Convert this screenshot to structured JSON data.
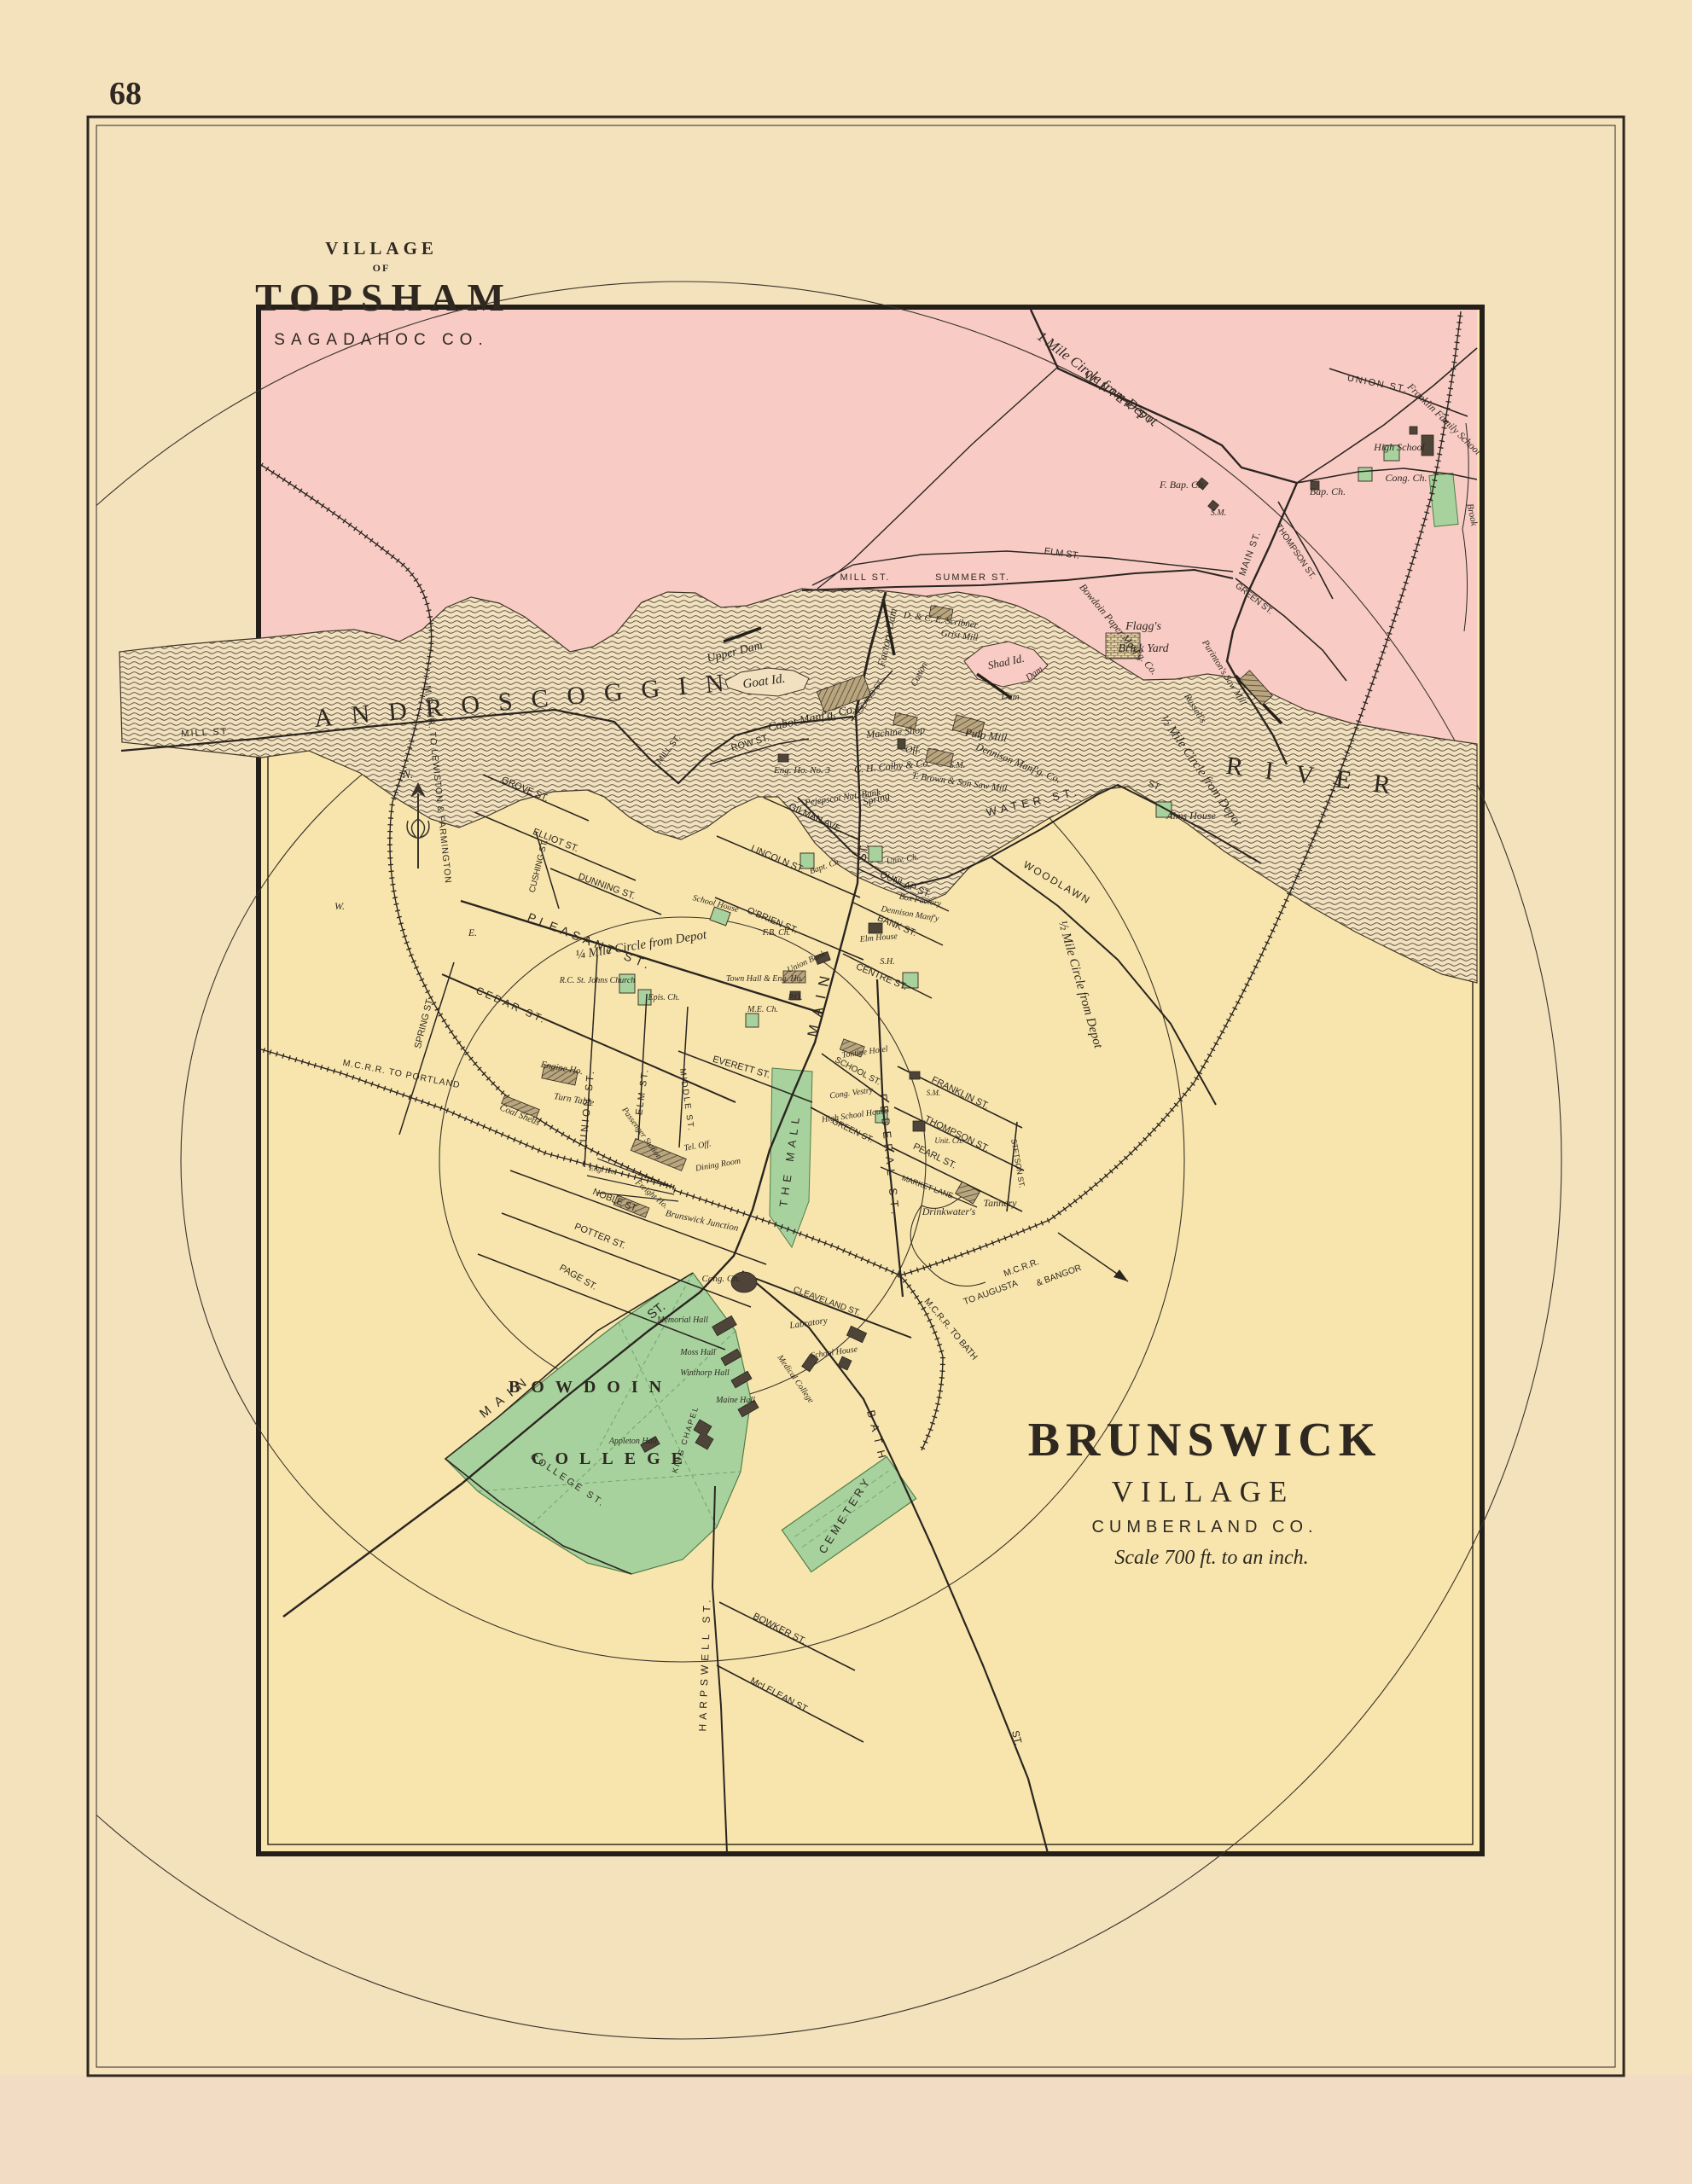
{
  "page": {
    "number": "68"
  },
  "titles": {
    "topsham": {
      "village": "VILLAGE",
      "of": "OF",
      "name": "TOPSHAM",
      "county": "SAGADAHOC CO."
    },
    "brunswick": {
      "name": "BRUNSWICK",
      "village": "VILLAGE",
      "county": "CUMBERLAND CO.",
      "scale": "Scale 700 ft. to an inch."
    }
  },
  "river": {
    "androscoggin": "ANDROSCOGGIN",
    "river": "RIVER",
    "upper_dam": "Upper Dam",
    "goat_island": "Goat Id.",
    "factory_dam": "Factory Dam",
    "cotton": "Cotton",
    "shad_island": "Shad Id.",
    "dam1": "Dam",
    "dam2": "Dam",
    "purinton": "Purinton's Saw Mill",
    "russells": "Russell's",
    "bowdoin_paper": "Bowdoin Paper Manf'g. Co.",
    "brook": "Brook"
  },
  "circles": {
    "one_mile": "1 Mile Circle from Depot",
    "half_mile": "½ Mile Circle from Depot",
    "quarter_mile": "¼ Mile Circle from Depot"
  },
  "compass": {
    "north": "N."
  },
  "railroads": {
    "lewiston": "M.C.R.R. TO LEWISTON & FARMINGTON",
    "portland": "M.C.R.R. TO PORTLAND",
    "mcrr": "M.C.R.R.",
    "augusta": "TO AUGUSTA",
    "bangor": "& BANGOR",
    "bath": "M.C.R.R. TO BATH"
  },
  "topsham": {
    "streets": {
      "winter": "WINTER ST.",
      "union": "UNION ST.",
      "mill": "MILL ST.",
      "summer": "SUMMER ST.",
      "elm": "ELM ST.",
      "main": "MAIN ST.",
      "thompson": "THOMPSON ST.",
      "green": "GREEN ST."
    },
    "places": {
      "franklin_family": "Franklin Family School",
      "high_school": "High School",
      "cong_ch": "Cong. Ch.",
      "bap_ch": "Bap. Ch.",
      "f_bap_ch": "F. Bap. Ch.",
      "sm": "S.M.",
      "flaggs": "Flagg's",
      "brick_yard": "Brick Yard"
    }
  },
  "brunswick": {
    "streets": {
      "mill": "MILL ST.",
      "mill2": "MILL ST.",
      "row": "ROW ST.",
      "island": "ISLAND ST.",
      "grove": "GROVE ST.",
      "elliot": "ELLIOT ST.",
      "cushing": "CUSHING ST.",
      "dunning": "DUNNING ST.",
      "pleasant": "PLEASANT ST.",
      "cedar": "CEDAR ST.",
      "spring": "SPRING ST.",
      "lincoln": "LINCOLN ST.",
      "obrien": "O'BRIEN ST.",
      "gilman": "GILMAN AVE.",
      "dunlap": "DUNLAP ST.",
      "bank": "BANK ST.",
      "centre": "CENTRE ST.",
      "main_upper": "MAIN",
      "main_upper_st": "ST.",
      "main_lower": "MAIN",
      "main_lower_st": "ST.",
      "water": "WATER ST.",
      "water2": "ST.",
      "woodlawn": "WOODLAWN",
      "union": "UNION ST.",
      "elm": "ELM ST.",
      "middle": "MIDDLE ST.",
      "everett": "EVERETT ST.",
      "noble": "NOBLE ST.",
      "potter": "POTTER ST.",
      "page": "PAGE ST.",
      "school": "SCHOOL ST.",
      "green": "GREEN ST.",
      "federal": "FEDERAL ST.",
      "franklin": "FRANKLIN ST.",
      "thompson": "THOMPSON ST.",
      "pearl": "PEARL ST.",
      "stetson": "STETSON ST.",
      "market": "MARKET LANE",
      "cleaveland": "CLEAVELAND ST.",
      "bath": "BATH",
      "bath_st": "ST.",
      "harpswell": "HARPSWELL ST.",
      "bowker": "BOWKER ST.",
      "mclelean": "McLELEAN ST.",
      "college": "COLLEGE ST.",
      "the_mall": "THE MALL",
      "w": "W.",
      "e": "E."
    },
    "places": {
      "cabot": "Cabot Manf'g. Co.",
      "eng_ho3": "Eng. Ho. No. 3",
      "scribner": "D. & C. E. Scribner",
      "grist": "Grist Mill",
      "machine": "Machine Shop",
      "off": "Off.",
      "colby": "C. H. Colby & Co.",
      "pulp": "Pulp Mill",
      "dennison_co": "Dennison Manf'g. Co.",
      "sm1": "S.M.",
      "brown": "T. Brown & Son Saw Mill",
      "spring": "Spring",
      "pejepscot": "Pejepscot Nat. Bank",
      "bapt": "Bapt. Ch.",
      "univ": "Univ. Ch.",
      "box": "Box Factory",
      "dennison_mfy": "Dennison Manf'y",
      "elm_house": "Elm House",
      "sh": "S.H.",
      "union_bank": "Union Bank",
      "fb": "F.B. Ch.",
      "town_hall": "Town Hall & Eng. Ho.",
      "po": "P.O.",
      "me": "M.E. Ch.",
      "school_house_w": "School House",
      "rc": "R.C. St. Johns Church",
      "epis": "Epis. Ch.",
      "tontine": "Tontine Hotel",
      "vestry": "Cong. Vestry",
      "hsh": "High School House",
      "sm2": "S.M.",
      "unit": "Unit. Ch.",
      "drinkwater": "Drinkwater's",
      "tannery": "Tannery",
      "alms": "Alms House",
      "cong": "Cong. Ch.",
      "labratory": "Labratory",
      "school_house_e": "School House",
      "medical": "Medical College",
      "cemetery": "CEMETERY",
      "passenger": "Passenger Station",
      "tel": "Tel. Off.",
      "dining": "Dining Room",
      "freight": "Freight Ho.",
      "eng_ho": "Eng. Ho.",
      "junction": "Brunswick Junction",
      "engine_ho": "Engine Ho.",
      "turntable": "Turn Table",
      "coal": "Coal Sheds"
    }
  },
  "college": {
    "bowdoin": "BOWDOIN",
    "college": "COLLEGE",
    "memorial": "Memorial Hall",
    "moss": "Moss Hall",
    "winthorp": "Winthorp Hall",
    "maine_hall": "Maine Hall",
    "chapel": "KING CHAPEL",
    "appleton": "Appleton Hall"
  }
}
